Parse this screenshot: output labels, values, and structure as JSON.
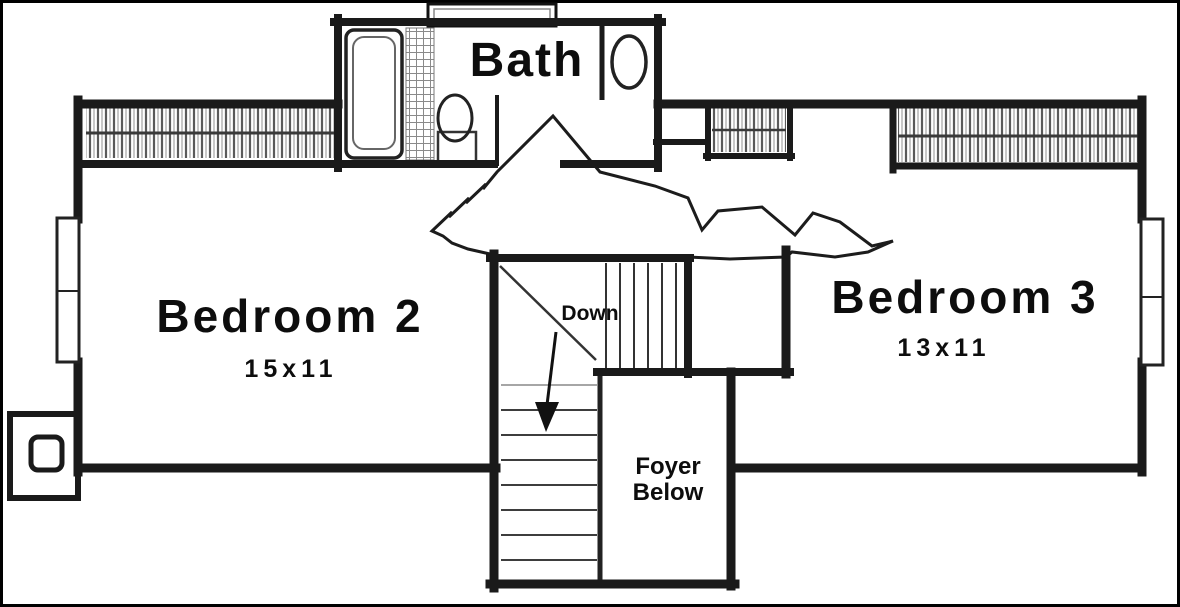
{
  "plan": {
    "kind": "second-floor-plan",
    "labels": {
      "bath": "Bath",
      "bedroom2": "Bedroom 2",
      "bedroom2_size": "15x11",
      "bedroom3": "Bedroom 3",
      "bedroom3_size": "13x11",
      "stairs": "Down",
      "foyer_line1": "Foyer",
      "foyer_line2": "Below"
    },
    "colors": {
      "background": "#ffffff",
      "wall": "#1a1a1a",
      "hatch": "#5a5a5a",
      "detail": "#333333",
      "frame": "#000000"
    }
  }
}
